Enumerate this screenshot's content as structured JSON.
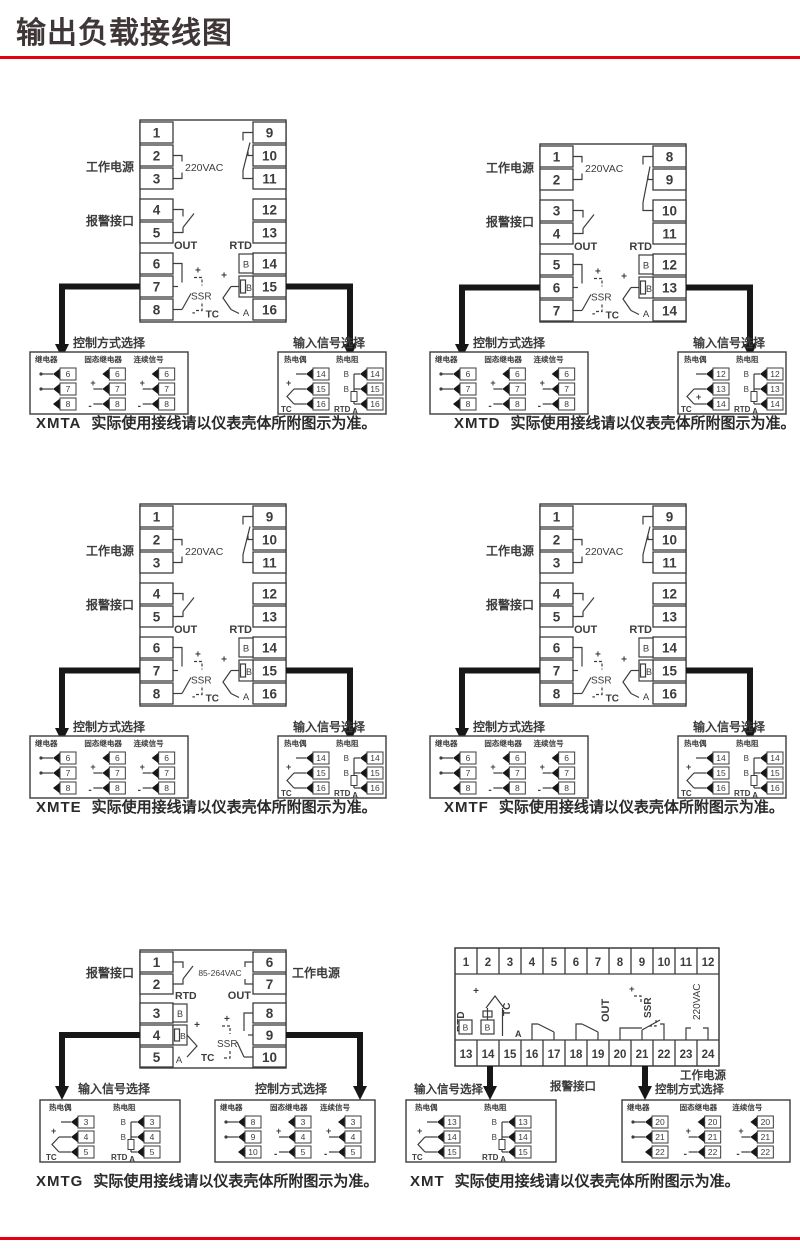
{
  "page": {
    "title": "输出负载接线图",
    "accent_color": "#e50011"
  },
  "labels": {
    "work_power": "工作电源",
    "alarm_port": "报警接口",
    "control_select": "控制方式选择",
    "input_select": "输入信号选择",
    "relay": "继电器",
    "solid_state_relay": "固态继电器",
    "continuous_signal": "连续信号",
    "thermocouple": "热电偶",
    "thermal_resistance": "热电阻",
    "out": "OUT",
    "rtd": "RTD",
    "tc": "TC",
    "ssr": "SSR",
    "b": "B",
    "a": "A",
    "plus": "+",
    "minus": "-"
  },
  "devices": [
    {
      "model": "XMTA",
      "caption": "实际使用接线请以仪表壳体所附图示为准。",
      "power_label": "220VAC",
      "left_terminals": [
        1,
        2,
        3,
        4,
        5,
        6,
        7,
        8
      ],
      "right_terminals": [
        9,
        10,
        11,
        12,
        13,
        14,
        15,
        16
      ],
      "control_options": [
        {
          "label": "继电器",
          "terminals": [
            6,
            7,
            8
          ]
        },
        {
          "label": "固态继电器",
          "terminals": [
            6,
            7,
            8
          ]
        },
        {
          "label": "连续信号",
          "terminals": [
            6,
            7,
            8
          ]
        }
      ],
      "input_terminals": {
        "tc": [
          14,
          15,
          16
        ],
        "rtd": [
          14,
          15,
          16
        ]
      },
      "tc_plus": "mid"
    },
    {
      "model": "XMTD",
      "caption": "实际使用接线请以仪表壳体所附图示为准。",
      "power_label": "220VAC",
      "left_terminals": [
        1,
        2,
        3,
        4,
        5,
        6,
        7
      ],
      "right_terminals": [
        8,
        9,
        10,
        11,
        12,
        13,
        14
      ],
      "control_options": [
        {
          "label": "继电器",
          "terminals": [
            6,
            7,
            8
          ]
        },
        {
          "label": "固态继电器",
          "terminals": [
            6,
            7,
            8
          ]
        },
        {
          "label": "连续信号",
          "terminals": [
            6,
            7,
            8
          ]
        }
      ],
      "input_terminals": {
        "tc": [
          12,
          13,
          14
        ],
        "rtd": [
          12,
          13,
          14
        ]
      },
      "tc_plus": "bottom"
    },
    {
      "model": "XMTE",
      "caption": "实际使用接线请以仪表壳体所附图示为准。",
      "power_label": "220VAC",
      "left_terminals": [
        1,
        2,
        3,
        4,
        5,
        6,
        7,
        8
      ],
      "right_terminals": [
        9,
        10,
        11,
        12,
        13,
        14,
        15,
        16
      ],
      "control_options": [
        {
          "label": "继电器",
          "terminals": [
            6,
            7,
            8
          ]
        },
        {
          "label": "固态继电器",
          "terminals": [
            6,
            7,
            8
          ]
        },
        {
          "label": "连续信号",
          "terminals": [
            6,
            7,
            8
          ]
        }
      ],
      "input_terminals": {
        "tc": [
          14,
          15,
          16
        ],
        "rtd": [
          14,
          15,
          16
        ]
      },
      "tc_plus": "mid"
    },
    {
      "model": "XMTF",
      "caption": "实际使用接线请以仪表壳体所附图示为准。",
      "power_label": "220VAC",
      "left_terminals": [
        1,
        2,
        3,
        4,
        5,
        6,
        7,
        8
      ],
      "right_terminals": [
        9,
        10,
        11,
        12,
        13,
        14,
        15,
        16
      ],
      "control_options": [
        {
          "label": "继电器",
          "terminals": [
            6,
            7,
            8
          ]
        },
        {
          "label": "固态继电器",
          "terminals": [
            6,
            7,
            8
          ]
        },
        {
          "label": "连续信号",
          "terminals": [
            6,
            7,
            8
          ]
        }
      ],
      "input_terminals": {
        "tc": [
          14,
          15,
          16
        ],
        "rtd": [
          14,
          15,
          16
        ]
      },
      "tc_plus": "mid"
    },
    {
      "model": "XMTG",
      "caption": "实际使用接线请以仪表壳体所附图示为准。",
      "power_label": "85-264VAC",
      "left_terminals": [
        1,
        2,
        3,
        4,
        5
      ],
      "right_terminals": [
        6,
        7,
        8,
        9,
        10
      ],
      "control_options": [
        {
          "label": "继电器",
          "terminals": [
            8,
            9,
            10
          ]
        },
        {
          "label": "固态继电器",
          "terminals": [
            3,
            4,
            5
          ]
        },
        {
          "label": "连续信号",
          "terminals": [
            3,
            4,
            5
          ]
        }
      ],
      "input_terminals": {
        "tc": [
          3,
          4,
          5
        ],
        "rtd": [
          3,
          4,
          5
        ]
      },
      "tc_plus": "mid"
    },
    {
      "model": "XMT",
      "caption": "实际使用接线请以仪表壳体所附图示为准。",
      "power_label": "220VAC",
      "top_terminals": [
        1,
        2,
        3,
        4,
        5,
        6,
        7,
        8,
        9,
        10,
        11,
        12
      ],
      "bottom_terminals": [
        13,
        14,
        15,
        16,
        17,
        18,
        19,
        20,
        21,
        22,
        23,
        24
      ],
      "control_options": [
        {
          "label": "继电器",
          "terminals": [
            20,
            21,
            22
          ]
        },
        {
          "label": "固态继电器",
          "terminals": [
            20,
            21,
            22
          ]
        },
        {
          "label": "连续信号",
          "terminals": [
            20,
            21,
            22
          ]
        }
      ],
      "input_terminals": {
        "tc": [
          13,
          14,
          15
        ],
        "rtd": [
          13,
          14,
          15
        ]
      },
      "tc_plus": "mid"
    }
  ]
}
